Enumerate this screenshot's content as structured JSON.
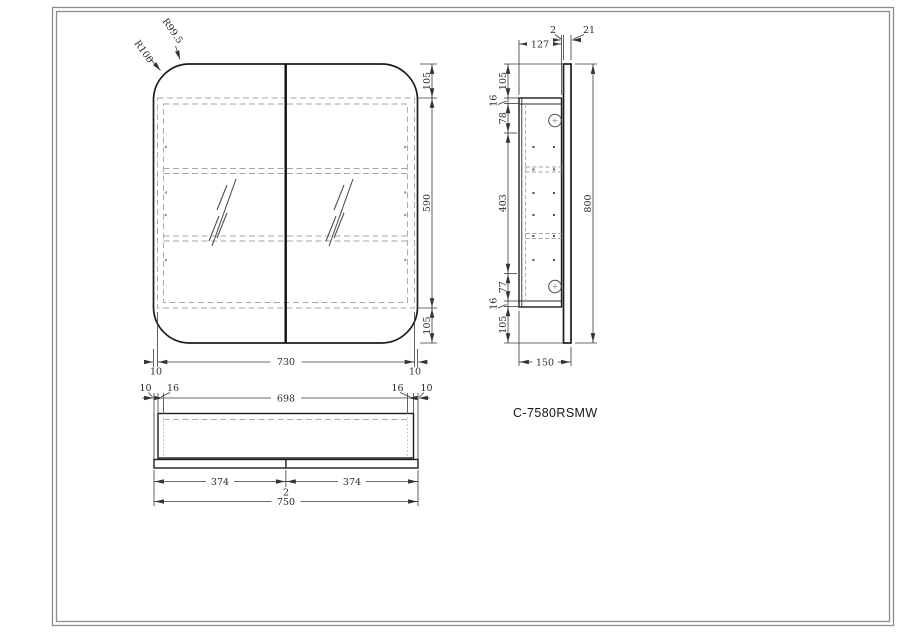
{
  "model": {
    "label": "C-7580RSMW"
  },
  "front": {
    "r_outer": "R100",
    "r_inner": "R99.5",
    "top": "105",
    "middle": "590",
    "bottom": "105",
    "body_width": "730",
    "gap_l": "10",
    "gap_r": "10"
  },
  "side": {
    "depth_body": "127",
    "gap": "2",
    "door_thk": "21",
    "c1": "105",
    "c2": "16",
    "c3": "78",
    "c4": "403",
    "c5": "77",
    "c6": "16",
    "c7": "105",
    "height": "800",
    "depth": "150"
  },
  "bottom": {
    "gap_l": "10",
    "wall_l": "16",
    "inner": "698",
    "wall_r": "16",
    "gap_r": "10",
    "door_l": "374",
    "gap_c": "2",
    "door_r": "374",
    "width": "750"
  }
}
